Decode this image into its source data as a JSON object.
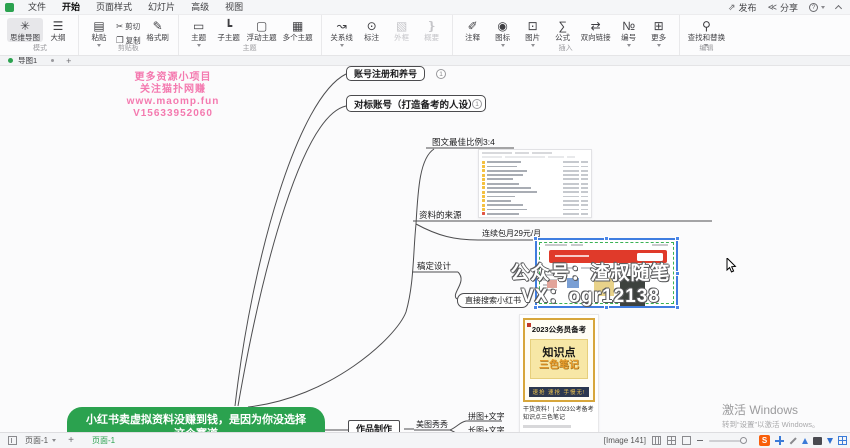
{
  "colors": {
    "accent_green": "#2ba24f",
    "selection_blue": "#3f7de0",
    "watermark_pink": "#f479af",
    "poster_gold": "#d7a63c",
    "banner_red": "#e03a2a",
    "tray_orange": "#f95e0a"
  },
  "menubar": {
    "tabs": [
      {
        "label": "文件"
      },
      {
        "label": "开始"
      },
      {
        "label": "页面样式"
      },
      {
        "label": "幻灯片"
      },
      {
        "label": "高级"
      },
      {
        "label": "视图"
      }
    ],
    "actions": {
      "publish": "发布",
      "share": "分享"
    },
    "icons": {
      "publish": "⇗",
      "share": "≪"
    }
  },
  "ribbon": {
    "groups": [
      {
        "label": "模式",
        "items": [
          {
            "label": "思维导图",
            "glyph": "✳"
          },
          {
            "label": "大纲",
            "glyph": "☰"
          }
        ]
      },
      {
        "label": "剪贴板",
        "items": [
          {
            "label": "粘贴",
            "glyph": "▤"
          },
          {
            "label": "剪切",
            "glyph": "✂"
          },
          {
            "label": "复制",
            "glyph": "❐"
          },
          {
            "label": "格式刷",
            "glyph": "✎"
          }
        ]
      },
      {
        "label": "主题",
        "items": [
          {
            "label": "主题",
            "glyph": "▭"
          },
          {
            "label": "子主题",
            "glyph": "┗"
          },
          {
            "label": "浮动主题",
            "glyph": "▢"
          },
          {
            "label": "多个主题",
            "glyph": "▦"
          }
        ]
      },
      {
        "label": "",
        "items": [
          {
            "label": "关系线",
            "glyph": "↝"
          },
          {
            "label": "标注",
            "glyph": "⊙"
          },
          {
            "label": "外框",
            "glyph": "▧"
          },
          {
            "label": "概要",
            "glyph": "❵"
          }
        ]
      },
      {
        "label": "插入",
        "items": [
          {
            "label": "注释",
            "glyph": "✐"
          },
          {
            "label": "图标",
            "glyph": "◉"
          },
          {
            "label": "图片",
            "glyph": "⊡"
          },
          {
            "label": "公式",
            "glyph": "∑"
          },
          {
            "label": "双向链接",
            "glyph": "⇄"
          },
          {
            "label": "编号",
            "glyph": "№"
          },
          {
            "label": "更多",
            "glyph": "⊞"
          }
        ]
      },
      {
        "label": "编辑",
        "items": [
          {
            "label": "查找和替换",
            "glyph": "⚲"
          }
        ]
      }
    ]
  },
  "doc_tabs": {
    "active_tab": "导图1",
    "add": "+"
  },
  "canvas": {
    "pink_watermark": {
      "line1": "更多资源小项目",
      "line2": "关注猫扑网赚",
      "line3": "www.maomp.fun",
      "line4": "V15633952060"
    },
    "white_watermark": {
      "line1": "公众号：渣叔随笔",
      "line2": "VX：ogr12138"
    },
    "central_topic": {
      "line1": "小红书卖虚拟资料没赚到钱，是因为你没选择",
      "line2": "这个赛道"
    },
    "nodes": {
      "register": "账号注册和养号",
      "benchmark": "对标账号（打造备考的人设）",
      "ratio": "图文最佳比例3:4",
      "source": "资料的来源",
      "subscription": "连续包月29元/月",
      "gaoding": "稿定设计",
      "search_xhs": "直接搜索小红书",
      "production": "作品制作",
      "meitu": "美图秀秀",
      "collage": "拼图+文字",
      "longimg": "长图+文字"
    },
    "badge": "1",
    "poster": {
      "title": "2023公务员备考",
      "headline": "知识点",
      "subhead": "三色笔记",
      "banner": "速抢 速抢 手慢无!",
      "caption": "干货资料！| 2023公考备考知识点三色笔记"
    },
    "activate": {
      "line1": "激活 Windows",
      "line2": "转到“设置”以激活 Windows。"
    }
  },
  "statusbar": {
    "page_selector": "页面-1",
    "page_tab": "页面-1",
    "image_label": "[Image 141]",
    "add": "+",
    "tray": {
      "sogou": "S"
    }
  }
}
